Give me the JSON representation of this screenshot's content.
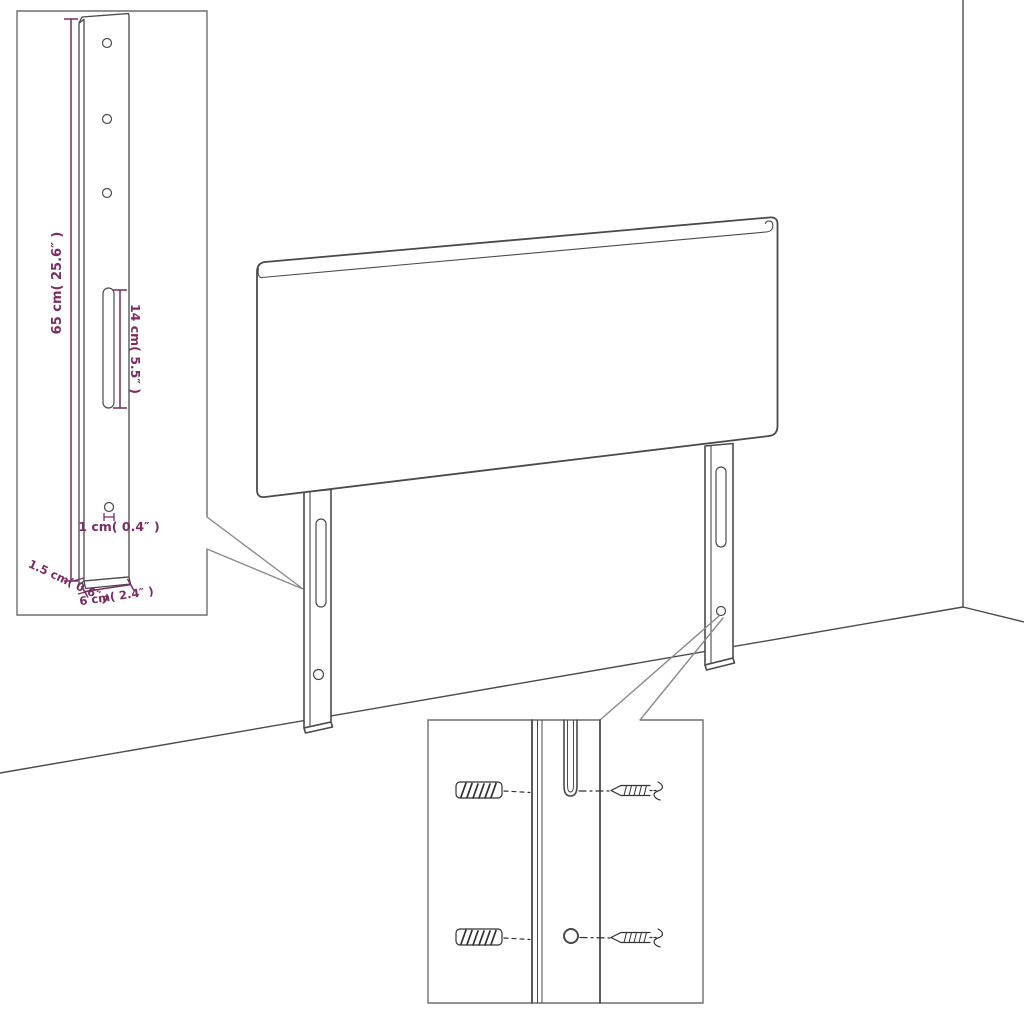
{
  "diagram": {
    "type": "furniture-assembly-dimension-diagram",
    "product": "upholstered headboard with two wall-mount legs",
    "dimension_labels": {
      "height": "65 cm( 25.6″ )",
      "slot_length": "14 cm( 5.5″ )",
      "hole_diameter": "1 cm( 0.4″ )",
      "thickness": "1.5 cm( 0.6″ )",
      "leg_width": "6 cm( 2.4″ )"
    },
    "insets": {
      "leg_dimension_inset": "close-up of mounting leg with dimensions",
      "hardware_inset": "close-up of leg slot and hole with wall plugs and screws"
    },
    "colors": {
      "dimension": "#7b2c61",
      "outline": "#4a4a4a",
      "callout": "#8a8a8a",
      "inset_border": "#6f6f6f",
      "background": "#ffffff"
    }
  }
}
